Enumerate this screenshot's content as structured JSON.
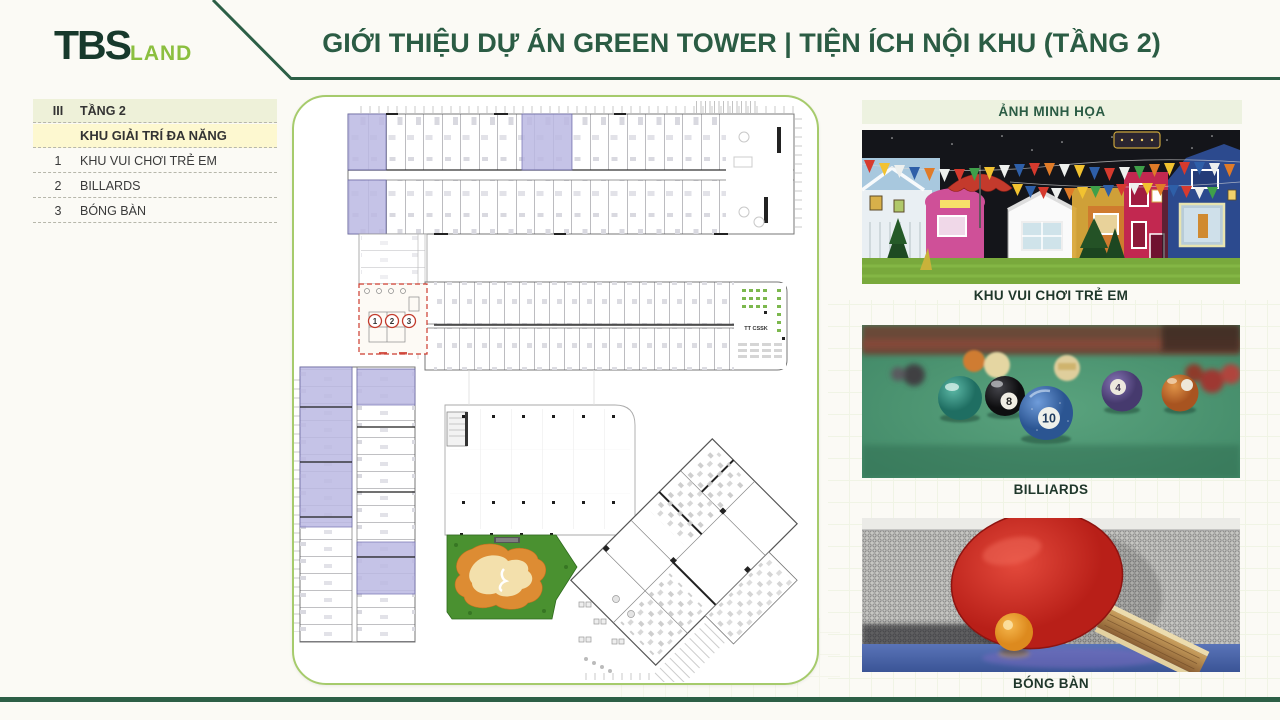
{
  "header": {
    "logo_primary": "TBS",
    "logo_secondary": "LAND",
    "title": "GIỚI THIỆU DỰ ÁN GREEN TOWER  |  TIỆN ÍCH NỘI KHU (TẦNG 2)"
  },
  "amenity_table": {
    "section_numeral": "III",
    "section_title": "TẦNG 2",
    "group_title": "KHU GIẢI TRÍ ĐA NĂNG",
    "rows": [
      {
        "no": "1",
        "label": "KHU VUI CHƠI TRẺ EM"
      },
      {
        "no": "2",
        "label": "BILLARDS"
      },
      {
        "no": "3",
        "label": "BÓNG BÀN"
      }
    ]
  },
  "floor_plan": {
    "markers": [
      "1",
      "2",
      "3"
    ],
    "area_label": "TT CSSK"
  },
  "gallery": {
    "header": "ẢNH MINH HỌA",
    "items": [
      {
        "caption": "KHU VUI CHƠI TRẺ EM"
      },
      {
        "caption": "BILLIARDS"
      },
      {
        "caption": "BÓNG BÀN"
      }
    ],
    "billiard_ball_numbers": [
      "8",
      "10",
      "4"
    ]
  },
  "colors": {
    "accent_dark_green": "#2c5f46",
    "accent_light_green": "#8bbf3f",
    "plan_border_green": "#a6cb6c",
    "highlight_purple": "#bcb9e3",
    "marker_red": "#cc3b2e",
    "lawn_green": "#4a9130",
    "table_row_olive": "#eef1d9",
    "table_row_yellow": "#fdf8d0"
  }
}
